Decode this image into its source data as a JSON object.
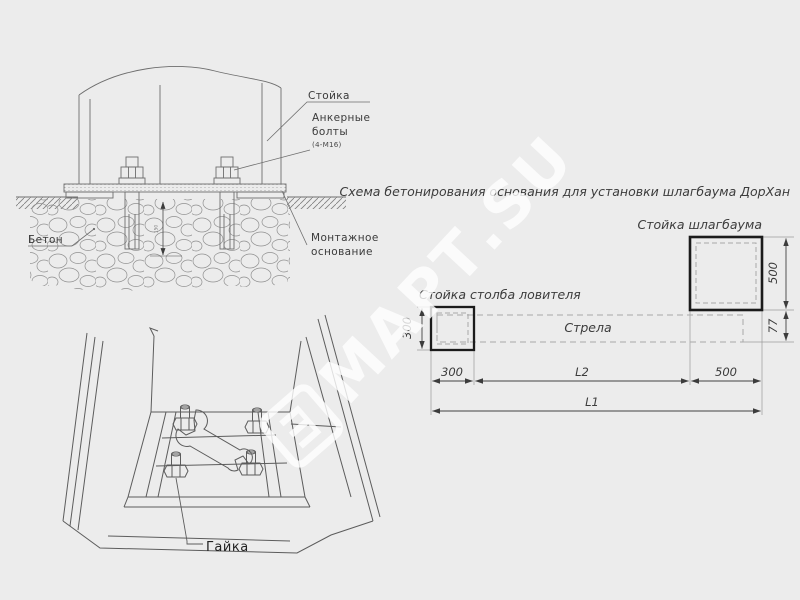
{
  "canvas": {
    "bg_color": "#ececec",
    "line_color": "#6e6e6e",
    "dark_line_color": "#1b1b1b",
    "text_color": "#3a3a3a",
    "watermark_color": "#ffffff"
  },
  "watermark": {
    "text": "МАРТ.SU",
    "logo_glyph": "Ш"
  },
  "section_view": {
    "post_label": "Стойка",
    "anchor_label_1": "Анкерные",
    "anchor_label_2": "болты",
    "anchor_note": "(4-М16)",
    "concrete_label": "Бетон",
    "base_label_1": "Монтажное",
    "base_label_2": "основание",
    "embed_dim": "150"
  },
  "perspective_view": {
    "nut_label": "Гайка"
  },
  "plan_view": {
    "title": "Схема бетонирования основания для установки шлагбаума ДорХан",
    "barrier_post_label": "Стойка шлагбаума",
    "catcher_post_label": "Стойка столба ловителя",
    "boom_label": "Стрела",
    "dim_left_height": "300",
    "dim_left_width": "300",
    "dim_right_height": "500",
    "dim_boom_drop": "77",
    "dim_mid": "L2",
    "dim_right_width": "500",
    "dim_total": "L1"
  }
}
